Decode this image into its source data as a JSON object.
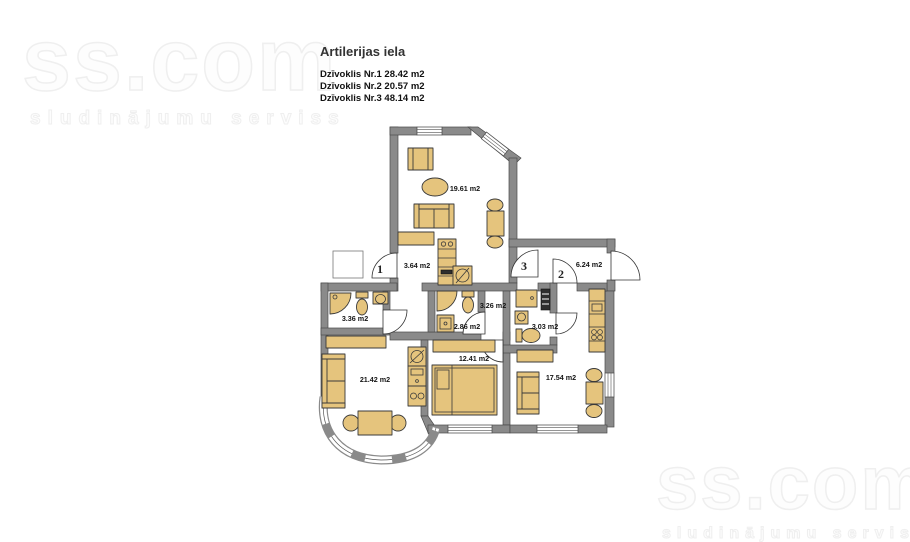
{
  "watermarks": {
    "brand": "ss.com",
    "tagline": "sludinājumu serviss"
  },
  "header": {
    "street": "Artilerijas iela",
    "apartments": [
      "Dzīvoklis Nr.1 28.42 m2",
      "Dzīvoklis Nr.2 20.57 m2",
      "Dzīvoklis Nr.3 48.14 m2"
    ]
  },
  "floorplan": {
    "unit_markers": {
      "unit1": "1",
      "unit2": "2",
      "unit3": "3"
    },
    "rooms": {
      "living_top": "19.61 m2",
      "hall1": "3.64 m2",
      "hall2": "6.24 m2",
      "bath1": "3.36 m2",
      "corridor3": "3.26 m2",
      "bath3": "2.86 m2",
      "bath2": "3.03 m2",
      "living_left": "21.42 m2",
      "bedroom": "12.41 m2",
      "living_right": "17.54 m2"
    },
    "colors": {
      "wall": "#8a8a8a",
      "wall_outline": "#4a4a4a",
      "furniture": "#e5c47d",
      "furniture_outline": "#3a3a3a",
      "door_stroke": "#333333",
      "window_frame": "#555555",
      "label_text": "#141414"
    }
  }
}
